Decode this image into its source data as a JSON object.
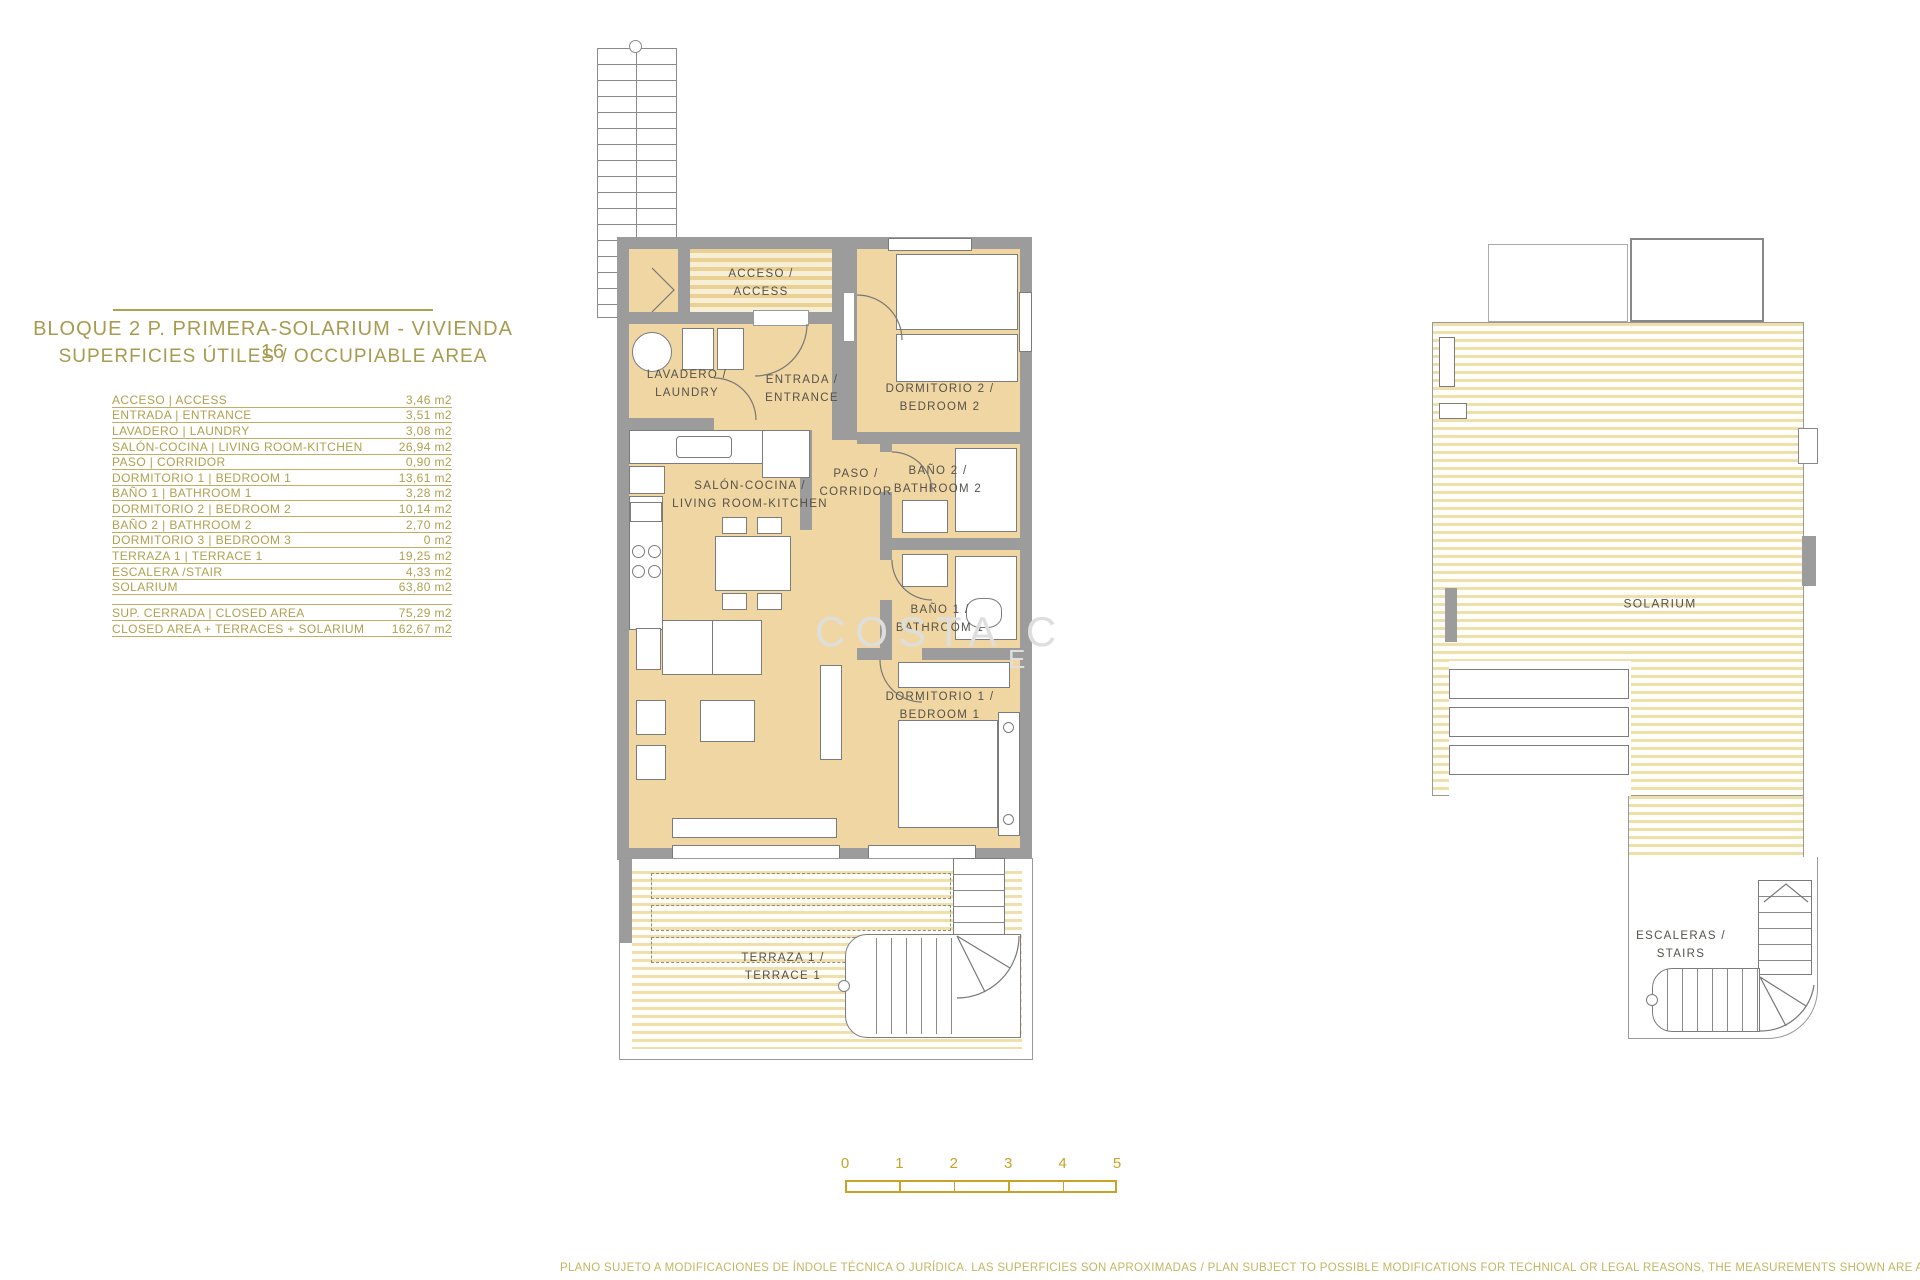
{
  "title": {
    "line1": "BLOQUE 2 P. PRIMERA-SOLARIUM - VIVIENDA 16",
    "line2": "SUPERFICIES ÚTILES / OCCUPIABLE AREA"
  },
  "areas_table": {
    "rows": [
      {
        "label": "ACCESO | ACCESS",
        "value": "3,46 m2"
      },
      {
        "label": "ENTRADA | ENTRANCE",
        "value": "3,51 m2"
      },
      {
        "label": "LAVADERO | LAUNDRY",
        "value": "3,08 m2"
      },
      {
        "label": "SALÓN-COCINA | LIVING ROOM-KITCHEN",
        "value": "26,94 m2"
      },
      {
        "label": "PASO | CORRIDOR",
        "value": "0,90 m2"
      },
      {
        "label": "DORMITORIO 1 | BEDROOM 1",
        "value": "13,61 m2"
      },
      {
        "label": "BAÑO 1 | BATHROOM 1",
        "value": "3,28 m2"
      },
      {
        "label": "DORMITORIO 2 | BEDROOM 2",
        "value": "10,14 m2"
      },
      {
        "label": "BAÑO 2 | BATHROOM 2",
        "value": "2,70 m2"
      },
      {
        "label": "DORMITORIO 3 | BEDROOM 3",
        "value": "0 m2"
      },
      {
        "label": "TERRAZA 1 | TERRACE 1",
        "value": "19,25 m2"
      },
      {
        "label": "ESCALERA /STAIR",
        "value": "4,33 m2"
      },
      {
        "label": "SOLARIUM",
        "value": "63,80 m2"
      }
    ],
    "summary": [
      {
        "label": "SUP. CERRADA | CLOSED AREA",
        "value": "75,29 m2"
      },
      {
        "label": "CLOSED AREA + TERRACES + SOLARIUM",
        "value": "162,67 m2"
      }
    ]
  },
  "floor_plan": {
    "rooms": {
      "acceso": {
        "line1": "ACCESO /",
        "line2": "ACCESS"
      },
      "lavadero": {
        "line1": "LAVADERO /",
        "line2": "LAUNDRY"
      },
      "entrada": {
        "line1": "ENTRADA /",
        "line2": "ENTRANCE"
      },
      "dormitorio2": {
        "line1": "DORMITORIO 2 /",
        "line2": "BEDROOM 2"
      },
      "paso": {
        "line1": "PASO /",
        "line2": "CORRIDOR"
      },
      "bano2": {
        "line1": "BAÑO 2 /",
        "line2": "BATHROOM 2"
      },
      "salon": {
        "line1": "SALÓN-COCINA /",
        "line2": "LIVING ROOM-KITCHEN"
      },
      "bano1": {
        "line1": "BAÑO 1 /",
        "line2": "BATHROOM 1"
      },
      "dormitorio1": {
        "line1": "DORMITORIO 1 /",
        "line2": "BEDROOM 1"
      },
      "terraza": {
        "line1": "TERRAZA 1 /",
        "line2": "TERRACE 1"
      }
    }
  },
  "solarium_plan": {
    "solarium_label": "SOLARIUM",
    "stairs": {
      "line1": "ESCALERAS /",
      "line2": "STAIRS"
    }
  },
  "scale_bar": {
    "ticks": [
      "0",
      "1",
      "2",
      "3",
      "4",
      "5"
    ]
  },
  "watermark": {
    "line1": "COSTA C",
    "line2": "E"
  },
  "disclaimer": "PLANO SUJETO A MODIFICACIONES DE ÍNDOLE TÉCNICA O JURÍDICA. LAS SUPERFICIES SON APROXIMADAS / PLAN SUBJECT TO POSSIBLE MODIFICATIONS FOR TECHNICAL OR LEGAL REASONS, THE MEASUREMENTS SHOWN ARE APPROXIMATE",
  "colors": {
    "accent_gold": "#B1A04E",
    "scale_gold": "#C9A227",
    "wall_gray": "#9C9C9C",
    "room_fill": "#F0D6A2",
    "stripe_tan": "#EFDFAD",
    "label_gray": "#55514B"
  }
}
